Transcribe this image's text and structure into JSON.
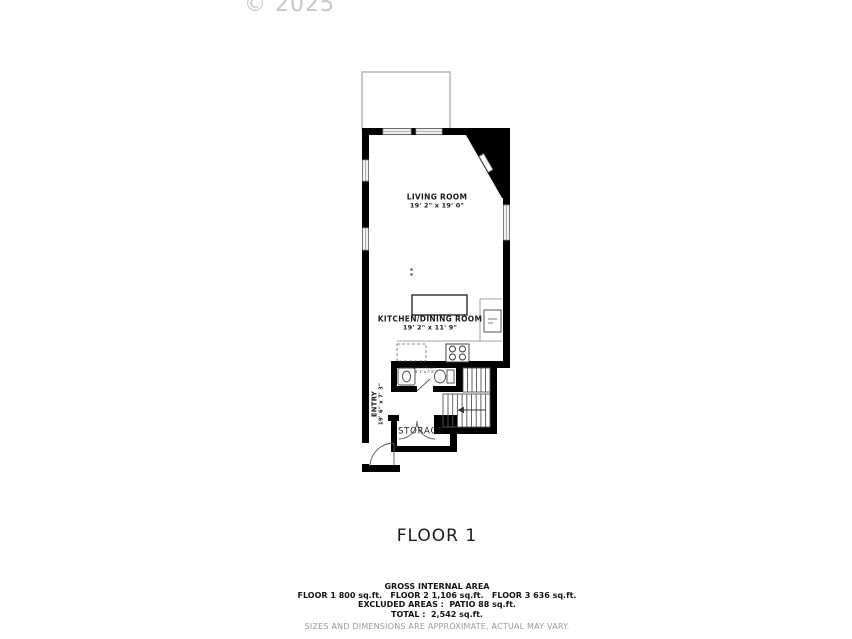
{
  "watermark": "© 2025",
  "floor_title": "FLOOR 1",
  "rooms": {
    "living_room": {
      "name": "LIVING ROOM",
      "dims": "19' 2\" x 19' 0\""
    },
    "kitchen_dining": {
      "name": "KITCHEN/DINING ROOM",
      "dims": "19' 2\" x 11' 9\""
    },
    "entry": {
      "name": "ENTRY",
      "dims": "19' 6\" x 7' 3\""
    },
    "bathroom": {
      "name": "BATHROOM",
      "dims": "5' 1\" x 7' 5\""
    },
    "storage": {
      "name": "STORAGE"
    }
  },
  "footer": {
    "gross_internal_area_title": "GROSS INTERNAL AREA",
    "floor_areas": "FLOOR 1 800 sq.ft.   FLOOR 2 1,106 sq.ft.   FLOOR 3 636 sq.ft.",
    "excluded_areas": "EXCLUDED AREAS :  PATIO 88 sq.ft.",
    "total": "TOTAL :  2,542 sq.ft.",
    "disclaimer": "SIZES AND DIMENSIONS ARE APPROXIMATE, ACTUAL MAY VARY."
  },
  "colors": {
    "wall": "#000000",
    "fixture_line": "#444444",
    "thin_line": "#888888",
    "window_fill": "#f2f2f2",
    "watermark": "#c7c7c7",
    "disclaimer_gray": "#9a9a9a"
  }
}
